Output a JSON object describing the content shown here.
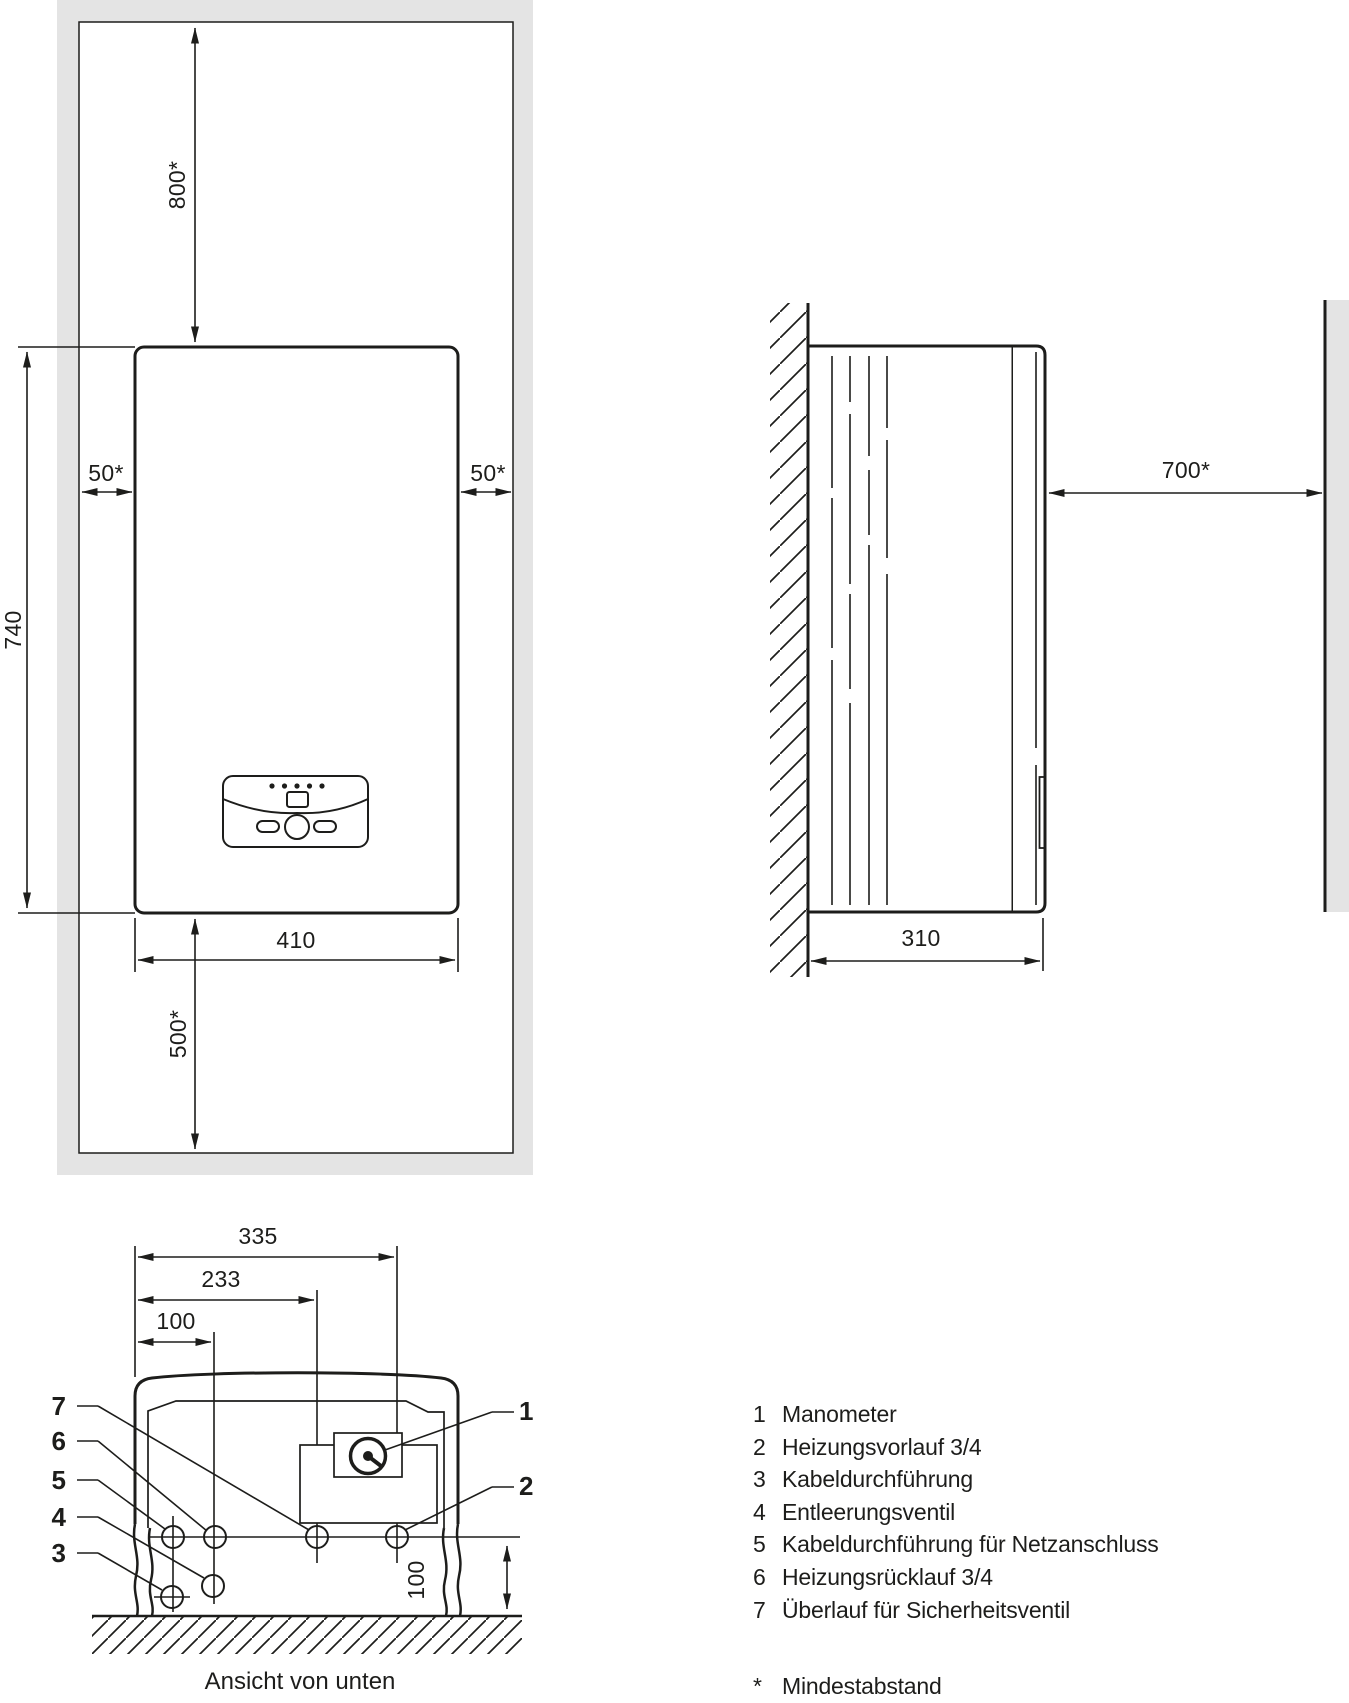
{
  "colors": {
    "ink": "#1d1d1b",
    "band": "#e4e4e4"
  },
  "front_view": {
    "dim_top": "800*",
    "dim_left_clearance": "50*",
    "dim_right_clearance": "50*",
    "dim_height": "740",
    "dim_width": "410",
    "dim_bottom": "500*"
  },
  "side_view": {
    "dim_clearance": "700*",
    "dim_depth": "310"
  },
  "bottom_view": {
    "dim_width_full": "335",
    "dim_width_mid": "233",
    "dim_width_small": "100",
    "dim_height": "100",
    "caption": "Ansicht von unten",
    "callouts_left": [
      "7",
      "6",
      "5",
      "4",
      "3"
    ],
    "callouts_right": [
      "1",
      "2"
    ]
  },
  "legend": {
    "items": [
      {
        "num": "1",
        "label": "Manometer"
      },
      {
        "num": "2",
        "label": "Heizungsvorlauf 3/4"
      },
      {
        "num": "3",
        "label": "Kabeldurchführung"
      },
      {
        "num": "4",
        "label": "Entleerungsventil"
      },
      {
        "num": "5",
        "label": "Kabeldurchführung für Netzanschluss"
      },
      {
        "num": "6",
        "label": "Heizungsrücklauf 3/4"
      },
      {
        "num": "7",
        "label": "Überlauf für Sicherheitsventil"
      }
    ],
    "footnote": {
      "symbol": "*",
      "label": "Mindestabstand"
    }
  }
}
